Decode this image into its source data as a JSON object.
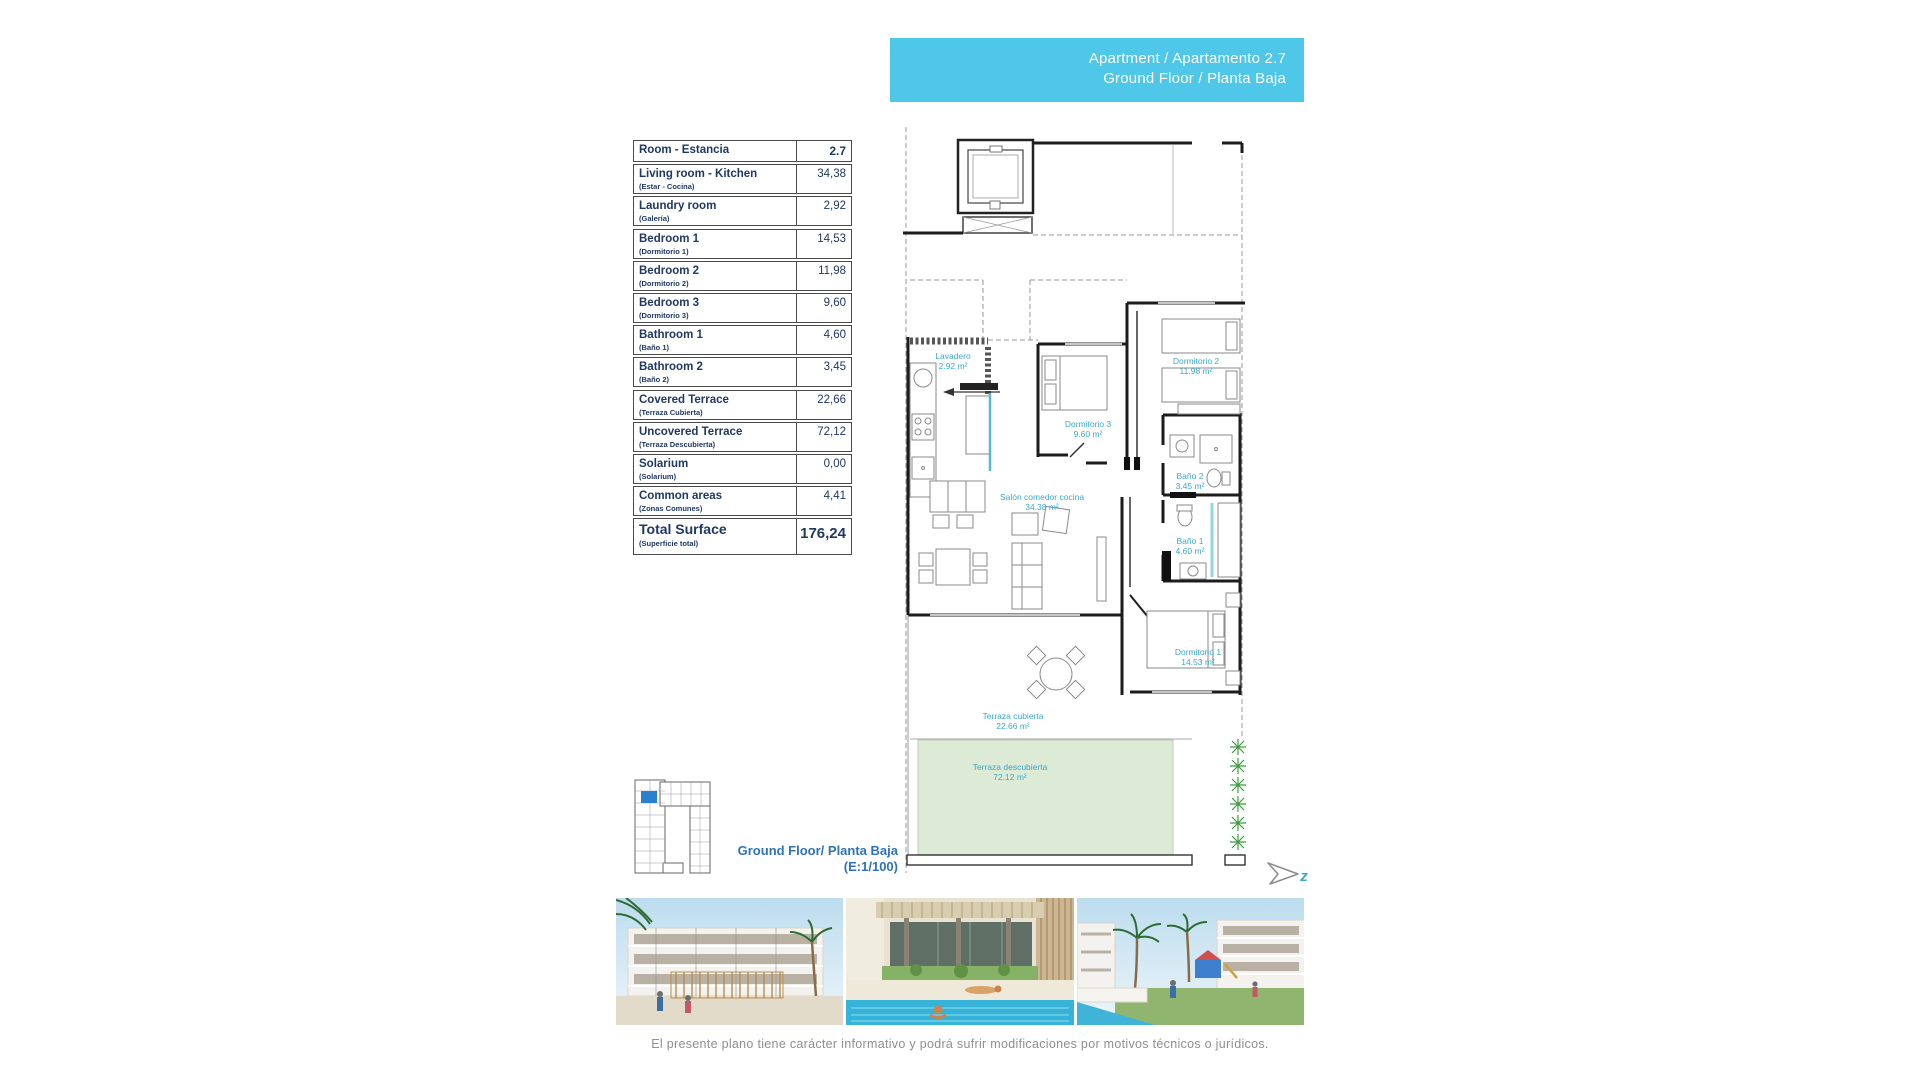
{
  "header": {
    "line1": "Apartment / Apartamento 2.7",
    "line2": "Ground Floor / Planta Baja",
    "bg_color": "#4fc7e8"
  },
  "area_table": {
    "header": {
      "label": "Room - Estancia",
      "value": "2.7"
    },
    "rows": [
      {
        "label": "Living room - Kitchen",
        "sub": "(Estar - Cocina)",
        "value": "34,38"
      },
      {
        "label": "Laundry room",
        "sub": "(Galería)",
        "value": "2,92"
      },
      {
        "label": "Bedroom 1",
        "sub": "(Dormitorio 1)",
        "value": "14,53"
      },
      {
        "label": "Bedroom 2",
        "sub": "(Dormitorio 2)",
        "value": "11,98"
      },
      {
        "label": "Bedroom 3",
        "sub": "(Dormitorio 3)",
        "value": "9,60"
      },
      {
        "label": "Bathroom 1",
        "sub": "(Baño 1)",
        "value": "4,60"
      },
      {
        "label": "Bathroom 2",
        "sub": "(Baño 2)",
        "value": "3,45"
      },
      {
        "label": "Covered Terrace",
        "sub": "(Terraza Cubierta)",
        "value": "22,66"
      },
      {
        "label": "Uncovered Terrace",
        "sub": "(Terraza Descubierta)",
        "value": "72,12"
      },
      {
        "label": "Solarium",
        "sub": "(Solarium)",
        "value": "0,00"
      },
      {
        "label": "Common areas",
        "sub": "(Zonas Comunes)",
        "value": "4,41"
      }
    ],
    "total": {
      "label": "Total Surface",
      "sub": "(Superficie total)",
      "value": "176,24"
    }
  },
  "plan": {
    "label_color": "#3aa8cd",
    "rooms": [
      {
        "id": "lavadero",
        "label": "Lavadero",
        "area": "2.92 m²"
      },
      {
        "id": "dormitorio-3",
        "label": "Dormitorio 3",
        "area": "9.60 m²"
      },
      {
        "id": "dormitorio-2",
        "label": "Dormitorio 2",
        "area": "11.98 m²"
      },
      {
        "id": "bano-2",
        "label": "Baño 2",
        "area": "3.45 m²"
      },
      {
        "id": "salon-comedor",
        "label": "Salón comedor cocina",
        "area": "34.38 m²"
      },
      {
        "id": "bano-1",
        "label": "Baño 1",
        "area": "4.60 m²"
      },
      {
        "id": "dormitorio-1",
        "label": "Dormitorio 1",
        "area": "14.53 m²"
      },
      {
        "id": "terraza-cubierta",
        "label": "Terraza cubierta",
        "area": "22.66 m²"
      },
      {
        "id": "terraza-descubierta",
        "label": "Terraza descubierta",
        "area": "72.12 m²"
      }
    ],
    "north_label": "z",
    "terrace_fill": "#dcead6",
    "plant_color": "#3f9b3f"
  },
  "floor_label": {
    "line1": "Ground Floor/ Planta Baja",
    "line2": "(E:1/100)",
    "color": "#2e74b5"
  },
  "key_plan": {
    "highlight_color": "#2a7fd0"
  },
  "photos": [
    {
      "name": "street-view-render"
    },
    {
      "name": "pool-lounge-render"
    },
    {
      "name": "playground-render"
    }
  ],
  "disclaimer": "El presente plano tiene carácter informativo y podrá sufrir modificaciones por motivos técnicos o jurídicos."
}
